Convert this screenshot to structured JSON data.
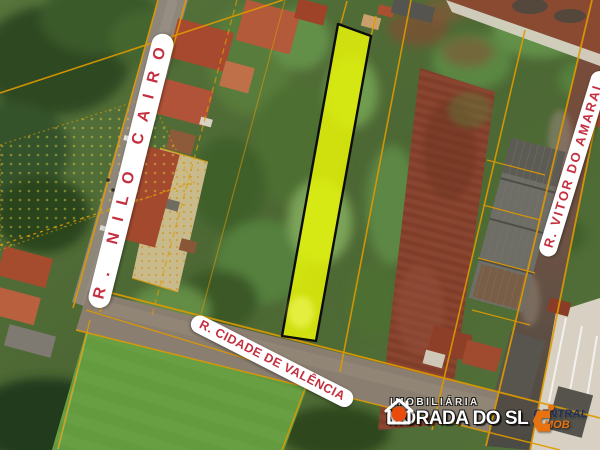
{
  "streets": {
    "nilo_cairo": "R. NILO CAIRO",
    "vitor_do_amaral": "R. VITOR DO AMARAL",
    "cidade_de_valencia": "R. CIDADE DE VALÊNCIA"
  },
  "logos": {
    "morada": {
      "line1": "IMOBILIÁRIA",
      "name": "MORADA DO SOL",
      "name_pre": "MORADA DO S",
      "name_post": "L",
      "icon": "house-sun-icon"
    },
    "central": {
      "name": "CENTRAL",
      "suffix": "MOB",
      "icon": "central-mob-c-icon"
    }
  },
  "colors": {
    "highlight_lot_fill": "#e9f607",
    "lot_boundary_line": "#e09a00",
    "street_label_text": "#c4303f",
    "street_label_bg": "#ffffff",
    "sun_icon": "#e84b0c",
    "brand_c_icon": "#e8720f",
    "brand_name_text": "#1f2f55",
    "brand_suffix_text": "#e8720f"
  }
}
